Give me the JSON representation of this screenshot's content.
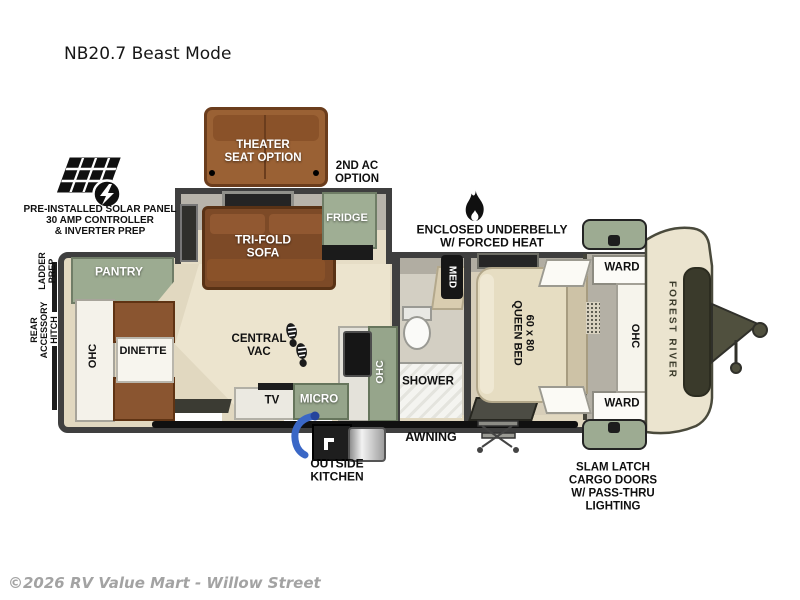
{
  "page": {
    "title": "NB20.7 Beast Mode",
    "copyright": "©2026 RV Value Mart - Willow Street"
  },
  "brand": {
    "name": "FOREST RIVER"
  },
  "colors": {
    "wall": "#3f3f3f",
    "floor_tan": "#e1d8c0",
    "cabinet_green": "#9cab91",
    "sofa_brown": "#7d4a27",
    "bed_cream": "#e6ddc2",
    "front_cap_cream": "#ebe4cf",
    "hose_blue": "#3a67c6",
    "label_white": "#ffffff",
    "label_black": "#101010"
  },
  "icons": {
    "solar_panel": "solar-panel-icon",
    "lightning_bolt": "lightning-bolt-icon",
    "flame": "flame-icon",
    "footprints": "footprints-icon",
    "hose": "outside-kitchen-hose-icon",
    "hitch": "trailer-hitch-icon",
    "steps": "entry-steps-icon"
  },
  "annotations": {
    "solar": {
      "line1": "PRE-INSTALLED SOLAR PANEL",
      "line2": "30 AMP CONTROLLER",
      "line3": "& INVERTER PREP"
    },
    "ladder_prep": {
      "line1": "LADDER",
      "line2": "PREP"
    },
    "rear_hitch": {
      "line1": "REAR",
      "line2": "ACCESSORY",
      "line3": "HITCH"
    },
    "second_ac": {
      "line1": "2ND AC",
      "line2": "OPTION"
    },
    "underbelly": {
      "line1": "ENCLOSED UNDERBELLY",
      "line2": "W/ FORCED HEAT"
    },
    "awning": "AWNING",
    "outside_kitchen": {
      "line1": "OUTSIDE",
      "line2": "KITCHEN"
    },
    "slam_latch": {
      "line1": "SLAM LATCH",
      "line2": "CARGO DOORS",
      "line3": "W/ PASS-THRU",
      "line4": "LIGHTING"
    }
  },
  "rooms": {
    "theater_seat": {
      "line1": "THEATER",
      "line2": "SEAT OPTION"
    },
    "trifold_sofa": {
      "line1": "TRI-FOLD",
      "line2": "SOFA"
    },
    "fridge": "FRIDGE",
    "pantry": "PANTRY",
    "ohc_rear": "OHC",
    "dinette": "DINETTE",
    "central_vac": {
      "line1": "CENTRAL",
      "line2": "VAC"
    },
    "tv": "TV",
    "micro": "MICRO",
    "ohc_kitchen": "OHC",
    "shower": "SHOWER",
    "med": "MED",
    "queen_bed": {
      "line1": "60 x 80",
      "line2": "QUEEN BED"
    },
    "ward_front_top": "WARD",
    "ward_front_bottom": "WARD",
    "ohc_front": "OHC"
  }
}
